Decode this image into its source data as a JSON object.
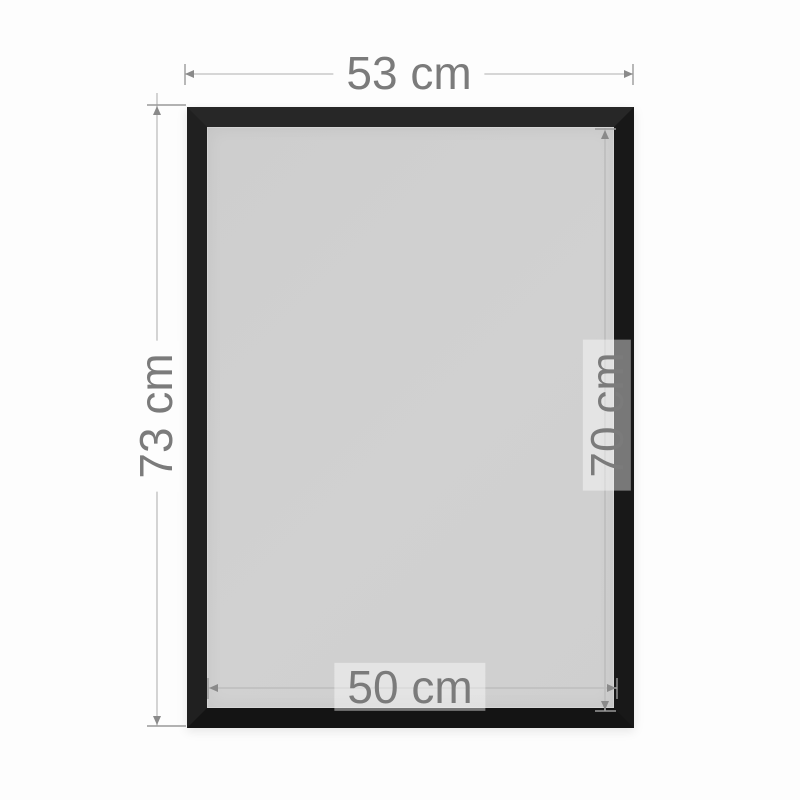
{
  "diagram": {
    "dimensions": {
      "top": {
        "label": "53 cm",
        "edge": "outer-width"
      },
      "left": {
        "label": "73 cm",
        "edge": "outer-height"
      },
      "right": {
        "label": "70 cm",
        "edge": "inner-height"
      },
      "bottom": {
        "label": "50 cm",
        "edge": "inner-width"
      }
    },
    "colors": {
      "background": "#fdfdfd",
      "frame": "#1d1d1d",
      "panel": "#d0d0d0",
      "dimension_line": "#c9c9c9",
      "dimension_line_inner": "#bdbdbd",
      "dimension_tick": "#9a9a9a",
      "label_text": "#7b7b7b"
    }
  }
}
